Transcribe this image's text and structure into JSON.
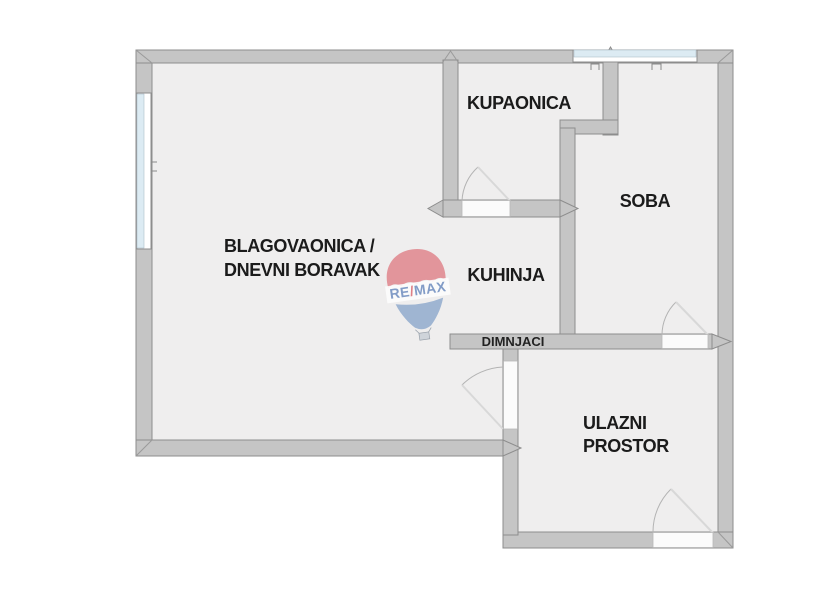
{
  "rooms": {
    "living": {
      "line1": "BLAGOVAONICA /",
      "line2": "DNEVNI BORAVAK"
    },
    "kupaonica": {
      "label": "KUPAONICA"
    },
    "soba": {
      "label": "SOBA"
    },
    "kuhinja": {
      "label": "KUHINJA"
    },
    "dimnjaci": {
      "label": "DIMNJACI"
    },
    "ulazni": {
      "line1": "ULAZNI",
      "line2": "PROSTOR"
    }
  },
  "logo": {
    "re": "RE",
    "slash": "/",
    "max": "MAX"
  },
  "colors": {
    "wall": "#c5c5c5",
    "wall_edge": "#8d8d8d",
    "room": "#efeeee",
    "window_glass": "#dcebf3",
    "door": "#fbfbfb",
    "label_text": "#1b1b1b",
    "logo_red": "#dd737b",
    "logo_blue": "#8ba6cb",
    "logo_text_blue": "#6d8cbe"
  }
}
